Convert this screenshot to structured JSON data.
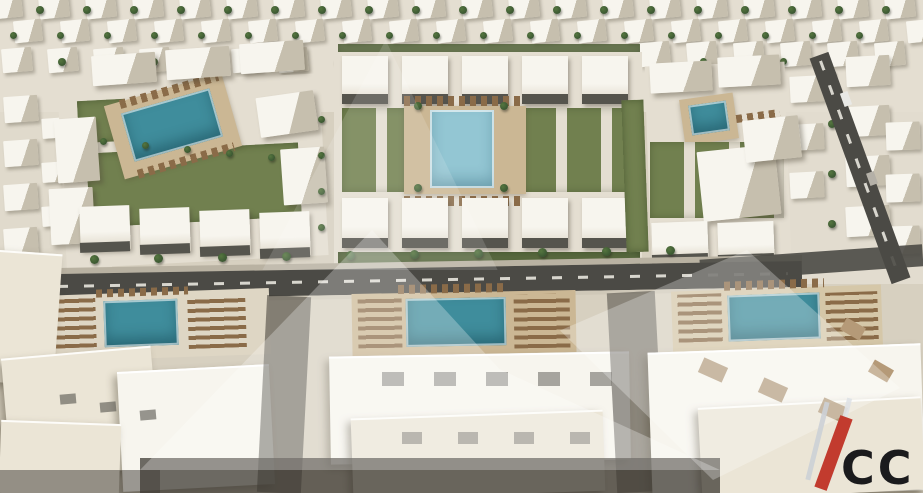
{
  "meta": {
    "image_type": "3d-aerial-architectural-render",
    "description": "Bird's-eye render of a white low-rise residential compound: rows of villas at the horizon, three landscaped courtyard blocks with swimming pools and green garden strips, a main road with street trees, and large foreground apartment rooftops with three pool terraces lined with sun loungers."
  },
  "watermark": {
    "logo_text": "CC"
  },
  "scene": {
    "palette": {
      "sand": "#d7d0c0",
      "sand_light": "#e4ded1",
      "roof_white": "#f7f5ee",
      "roof_shade": "#c6bfae",
      "cream": "#ebe5d6",
      "pool": "#3f8d9c",
      "pool_light": "#93c6d3",
      "grass": "#71804f",
      "grass_dark": "#5a6b40",
      "tree": "#3b5732",
      "road": "#4b4a45",
      "deck": "#cbb794",
      "lounger": "#8a6b48",
      "shade": "#3e3a33",
      "accent_red": "#c23b2e",
      "logo_gray": "#ccd0d6",
      "logo_dark": "#1b1b1d"
    },
    "elements": [
      {
        "n": "ground",
        "x": 0,
        "y": 0,
        "w": 923,
        "h": 493,
        "c": "sand"
      },
      {
        "n": "ground-top",
        "x": 0,
        "y": 0,
        "w": 923,
        "h": 112,
        "c": "sand_light"
      },
      {
        "n": "ground-right",
        "x": 736,
        "y": 36,
        "w": 187,
        "h": 248,
        "c": "sand_light",
        "o": 0.85
      },
      {
        "n": "ground-left",
        "x": 0,
        "y": 96,
        "w": 112,
        "h": 210,
        "c": "sand_light",
        "o": 0.7
      },
      {
        "cls": "villa",
        "n": "villa",
        "x": -8,
        "y": -6,
        "w": 30,
        "h": 24,
        "r": -6,
        "repeat": 20,
        "dx": 47
      },
      {
        "cls": "villa",
        "n": "villa",
        "x": 14,
        "y": 20,
        "w": 28,
        "h": 22,
        "r": -6,
        "repeat": 20,
        "dx": 47
      },
      {
        "cls": "villa",
        "n": "villa",
        "x": 2,
        "y": 48,
        "w": 30,
        "h": 24,
        "r": -5,
        "repeat": 7,
        "dx": 46
      },
      {
        "cls": "villa",
        "n": "villa",
        "x": 640,
        "y": 42,
        "w": 30,
        "h": 24,
        "r": -5,
        "repeat": 6,
        "dx": 47
      },
      {
        "cls": "villa",
        "n": "villa",
        "x": 4,
        "y": 96,
        "w": 34,
        "h": 26,
        "r": -4,
        "repeat": 4,
        "dy": 44
      },
      {
        "cls": "villa",
        "n": "villa",
        "x": 42,
        "y": 118,
        "w": 26,
        "h": 20,
        "r": -4,
        "repeat": 3,
        "dy": 44
      },
      {
        "cls": "villa",
        "n": "villa",
        "x": 846,
        "y": 56,
        "w": 44,
        "h": 30,
        "r": -3,
        "repeat": 4,
        "dy": 50
      },
      {
        "cls": "villa",
        "n": "villa",
        "x": 790,
        "y": 76,
        "w": 34,
        "h": 26,
        "r": -3,
        "repeat": 3,
        "dy": 48
      },
      {
        "cls": "villa",
        "n": "villa",
        "x": 886,
        "y": 122,
        "w": 34,
        "h": 28,
        "r": -2,
        "repeat": 3,
        "dy": 52
      },
      {
        "cls": "tree",
        "n": "tree",
        "x": 36,
        "y": 6,
        "w": 8,
        "h": 8,
        "repeat": 19,
        "dx": 47
      },
      {
        "cls": "tree",
        "n": "tree",
        "x": 10,
        "y": 32,
        "w": 7,
        "h": 7,
        "repeat": 19,
        "dx": 47
      },
      {
        "cls": "tree",
        "n": "tree",
        "x": 58,
        "y": 58,
        "w": 8,
        "h": 8,
        "repeat": 7,
        "dx": 46
      },
      {
        "cls": "tree",
        "n": "palm-tree",
        "x": 828,
        "y": 70,
        "w": 8,
        "h": 8,
        "repeat": 4,
        "dy": 50
      },
      {
        "cls": "tree",
        "n": "palm-tree",
        "x": 700,
        "y": 58,
        "w": 7,
        "h": 7,
        "repeat": 4,
        "dx": 40
      },
      {
        "cls": "road",
        "n": "right-road",
        "x": 850,
        "y": 48,
        "w": 20,
        "h": 240,
        "r": -20
      },
      {
        "cls": "dashv",
        "n": "right-road-line",
        "x": 858,
        "y": 54,
        "w": 3,
        "h": 228,
        "r": -20
      },
      {
        "n": "car",
        "x": 842,
        "y": 92,
        "w": 8,
        "h": 14,
        "c": "#e9e9e6",
        "r": -20
      },
      {
        "n": "car",
        "x": 868,
        "y": 172,
        "w": 8,
        "h": 13,
        "c": "#b4b0a7",
        "r": -20
      },
      {
        "n": "block-left-base",
        "x": 62,
        "y": 80,
        "w": 262,
        "h": 182,
        "c": "sand_light",
        "r": -3
      },
      {
        "cls": "grass",
        "n": "lawn",
        "x": 88,
        "y": 148,
        "w": 212,
        "h": 74,
        "r": -3
      },
      {
        "cls": "grass",
        "n": "lawn",
        "x": 78,
        "y": 100,
        "w": 48,
        "h": 42,
        "r": -3
      },
      {
        "cls": "deck",
        "n": "pool-deck",
        "x": 112,
        "y": 88,
        "w": 122,
        "h": 76,
        "r": -16
      },
      {
        "cls": "loungers",
        "n": "sun-loungers",
        "x": 118,
        "y": 86,
        "w": 102,
        "h": 9,
        "r": -16
      },
      {
        "cls": "pool",
        "n": "swimming-pool",
        "x": 126,
        "y": 100,
        "w": 92,
        "h": 50,
        "r": -16
      },
      {
        "cls": "loungers",
        "n": "sun-loungers",
        "x": 136,
        "y": 156,
        "w": 100,
        "h": 9,
        "r": -16
      },
      {
        "cls": "bldg",
        "n": "apartment-building",
        "x": 92,
        "y": 54,
        "w": 64,
        "h": 30,
        "r": -4,
        "repeat": 3,
        "dx": 74,
        "dy": -6
      },
      {
        "cls": "bldg",
        "n": "apartment-building",
        "x": 56,
        "y": 118,
        "w": 42,
        "h": 64,
        "r": -4
      },
      {
        "cls": "bldg",
        "n": "apartment-building",
        "x": 50,
        "y": 188,
        "w": 44,
        "h": 56,
        "r": -3
      },
      {
        "cls": "bldg",
        "n": "apartment-building",
        "x": 258,
        "y": 94,
        "w": 58,
        "h": 40,
        "r": -8
      },
      {
        "cls": "bldg",
        "n": "apartment-building",
        "x": 282,
        "y": 148,
        "w": 44,
        "h": 56,
        "r": -4
      },
      {
        "cls": "town",
        "n": "townhouse",
        "x": 80,
        "y": 206,
        "w": 50,
        "h": 44,
        "r": -2,
        "repeat": 4,
        "dx": 60,
        "dy": 2
      },
      {
        "cls": "winstrip",
        "n": "facade-windows",
        "x": 80,
        "y": 242,
        "w": 50,
        "h": 10,
        "r": -2,
        "repeat": 4,
        "dx": 60,
        "dy": 2
      },
      {
        "cls": "tree",
        "n": "tree",
        "x": 100,
        "y": 138,
        "w": 7,
        "h": 7,
        "repeat": 5,
        "dx": 42,
        "dy": 4
      },
      {
        "cls": "tree",
        "n": "tree",
        "x": 318,
        "y": 116,
        "w": 7,
        "h": 7,
        "repeat": 4,
        "dy": 36
      },
      {
        "n": "block-center-base",
        "x": 334,
        "y": 52,
        "w": 308,
        "h": 214,
        "c": "sand_light"
      },
      {
        "cls": "grass",
        "n": "hedge",
        "x": 338,
        "y": 44,
        "w": 302,
        "h": 8,
        "c": "grass_dark",
        "o": 0.85
      },
      {
        "cls": "town",
        "n": "townhouse",
        "x": 342,
        "y": 56,
        "w": 46,
        "h": 48,
        "repeat": 5,
        "dx": 60
      },
      {
        "cls": "winstrip",
        "n": "facade-windows",
        "x": 342,
        "y": 94,
        "w": 46,
        "h": 10,
        "repeat": 5,
        "dx": 60
      },
      {
        "cls": "grassrow",
        "n": "garden-strips",
        "x": 342,
        "y": 108,
        "w": 292,
        "h": 84
      },
      {
        "cls": "deck",
        "n": "pool-deck",
        "x": 404,
        "y": 106,
        "w": 122,
        "h": 88
      },
      {
        "cls": "loungers",
        "n": "sun-loungers",
        "x": 404,
        "y": 96,
        "w": 118,
        "h": 10
      },
      {
        "cls": "pool-light",
        "n": "swimming-pool",
        "x": 430,
        "y": 110,
        "w": 64,
        "h": 78
      },
      {
        "cls": "loungers",
        "n": "sun-loungers",
        "x": 404,
        "y": 196,
        "w": 118,
        "h": 10
      },
      {
        "cls": "tree",
        "n": "palm-tree",
        "x": 414,
        "y": 102,
        "w": 8,
        "h": 8
      },
      {
        "cls": "tree",
        "n": "palm-tree",
        "x": 500,
        "y": 102,
        "w": 8,
        "h": 8
      },
      {
        "cls": "tree",
        "n": "palm-tree",
        "x": 414,
        "y": 184,
        "w": 8,
        "h": 8
      },
      {
        "cls": "tree",
        "n": "palm-tree",
        "x": 500,
        "y": 184,
        "w": 8,
        "h": 8
      },
      {
        "cls": "town",
        "n": "townhouse",
        "x": 342,
        "y": 198,
        "w": 46,
        "h": 50,
        "repeat": 5,
        "dx": 60
      },
      {
        "cls": "winstrip",
        "n": "facade-windows",
        "x": 342,
        "y": 238,
        "w": 46,
        "h": 10,
        "repeat": 5,
        "dx": 60
      },
      {
        "cls": "grass",
        "n": "hedge",
        "x": 338,
        "y": 252,
        "w": 302,
        "h": 12,
        "c": "grass_dark"
      },
      {
        "n": "block-right-base",
        "x": 648,
        "y": 64,
        "w": 140,
        "h": 200,
        "c": "sand_light",
        "r": -2
      },
      {
        "cls": "bldg",
        "n": "apartment-building",
        "x": 650,
        "y": 62,
        "w": 62,
        "h": 30,
        "r": -3
      },
      {
        "cls": "bldg",
        "n": "apartment-building",
        "x": 718,
        "y": 56,
        "w": 62,
        "h": 30,
        "r": -3
      },
      {
        "cls": "deck",
        "n": "pool-deck",
        "x": 682,
        "y": 96,
        "w": 54,
        "h": 46,
        "r": -8
      },
      {
        "cls": "pool",
        "n": "swimming-pool",
        "x": 690,
        "y": 103,
        "w": 38,
        "h": 30,
        "r": -8
      },
      {
        "cls": "loungers",
        "n": "sun-loungers",
        "x": 736,
        "y": 112,
        "w": 44,
        "h": 8,
        "r": -8
      },
      {
        "cls": "grassrow",
        "n": "garden-strips",
        "x": 650,
        "y": 142,
        "w": 134,
        "h": 76
      },
      {
        "cls": "bldg",
        "n": "apartment-building",
        "x": 700,
        "y": 148,
        "w": 78,
        "h": 70,
        "r": -6
      },
      {
        "cls": "bldg",
        "n": "apartment-building",
        "x": 744,
        "y": 118,
        "w": 56,
        "h": 42,
        "r": -6
      },
      {
        "cls": "town",
        "n": "townhouse",
        "x": 652,
        "y": 222,
        "w": 56,
        "h": 40,
        "r": -2,
        "repeat": 2,
        "dx": 66
      },
      {
        "cls": "winstrip",
        "n": "facade-windows",
        "x": 652,
        "y": 254,
        "w": 56,
        "h": 9,
        "r": -2,
        "repeat": 2,
        "dx": 66
      },
      {
        "cls": "grass",
        "n": "lawn",
        "x": 624,
        "y": 100,
        "w": 22,
        "h": 152,
        "r": -2
      },
      {
        "n": "sidewalk",
        "x": 0,
        "y": 262,
        "w": 802,
        "h": 6,
        "c": "#b9b2a2",
        "r": -1
      },
      {
        "cls": "road",
        "n": "main-road",
        "x": 0,
        "y": 268,
        "w": 802,
        "h": 26,
        "r": -1
      },
      {
        "cls": "dash",
        "n": "main-road-line",
        "x": 6,
        "y": 279,
        "w": 782,
        "h": 3,
        "r": -1
      },
      {
        "n": "curb",
        "x": 0,
        "y": 294,
        "w": 802,
        "h": 4,
        "c": "#cfc8b8",
        "r": -1
      },
      {
        "cls": "road",
        "n": "road-extension",
        "x": 700,
        "y": 252,
        "w": 223,
        "h": 22,
        "r": -4,
        "o": 0.9
      },
      {
        "cls": "tree",
        "n": "street-tree",
        "x": 26,
        "y": 256,
        "w": 9,
        "h": 9,
        "repeat": 11,
        "dx": 64,
        "dy": -1
      },
      {
        "n": "pool-terrace",
        "x": 40,
        "y": 292,
        "w": 230,
        "h": 66,
        "c": "#ded6c4",
        "r": -2
      },
      {
        "cls": "loungersv",
        "n": "sun-loungers",
        "x": 48,
        "y": 298,
        "w": 48,
        "h": 50,
        "r": -2
      },
      {
        "cls": "pool",
        "n": "swimming-pool",
        "x": 104,
        "y": 300,
        "w": 74,
        "h": 46,
        "r": -2
      },
      {
        "cls": "loungersv",
        "n": "sun-loungers",
        "x": 188,
        "y": 296,
        "w": 58,
        "h": 52,
        "r": -2
      },
      {
        "cls": "loungers",
        "n": "sun-loungers",
        "x": 96,
        "y": 288,
        "w": 92,
        "h": 8,
        "r": -2
      },
      {
        "cls": "roof",
        "n": "rooftop",
        "x": -6,
        "y": 252,
        "w": 64,
        "h": 130,
        "r": 4
      },
      {
        "cls": "roof",
        "n": "rooftop",
        "x": 6,
        "y": 352,
        "w": 150,
        "h": 120,
        "r": -5
      },
      {
        "cls": "roof-white",
        "n": "rooftop",
        "x": 120,
        "y": 368,
        "w": 152,
        "h": 118,
        "r": -3
      },
      {
        "cls": "roof",
        "n": "rooftop",
        "x": 0,
        "y": 422,
        "w": 120,
        "h": 71,
        "r": 2
      },
      {
        "cls": "winstrip",
        "n": "roof-vent",
        "x": 60,
        "y": 394,
        "w": 16,
        "h": 10,
        "r": -5,
        "repeat": 3,
        "dx": 40,
        "dy": 8,
        "o": 0.6
      },
      {
        "cls": "shade",
        "n": "alley-shadow",
        "x": 262,
        "y": 296,
        "w": 44,
        "h": 197,
        "r": 3,
        "o": 0.55
      },
      {
        "n": "pool-terrace",
        "x": 352,
        "y": 292,
        "w": 224,
        "h": 62,
        "c": "deck",
        "r": -1
      },
      {
        "cls": "loungersv",
        "n": "sun-loungers",
        "x": 358,
        "y": 296,
        "w": 44,
        "h": 52,
        "r": -1
      },
      {
        "cls": "pool",
        "n": "swimming-pool",
        "x": 406,
        "y": 298,
        "w": 100,
        "h": 48,
        "r": -1
      },
      {
        "cls": "loungersv",
        "n": "sun-loungers",
        "x": 514,
        "y": 294,
        "w": 56,
        "h": 54,
        "r": -1
      },
      {
        "cls": "loungers",
        "n": "sun-loungers",
        "x": 398,
        "y": 284,
        "w": 110,
        "h": 9,
        "r": -1
      },
      {
        "cls": "roof-white",
        "n": "rooftop",
        "x": 330,
        "y": 354,
        "w": 300,
        "h": 106,
        "r": -1
      },
      {
        "cls": "roof",
        "n": "rooftop",
        "x": 352,
        "y": 414,
        "w": 252,
        "h": 79,
        "r": -2
      },
      {
        "cls": "winstrip",
        "n": "roof-vent",
        "x": 382,
        "y": 372,
        "w": 22,
        "h": 14,
        "repeat": 5,
        "dx": 52,
        "o": 0.5
      },
      {
        "cls": "winstrip",
        "n": "roof-vent",
        "x": 402,
        "y": 432,
        "w": 20,
        "h": 12,
        "repeat": 4,
        "dx": 56,
        "o": 0.5
      },
      {
        "cls": "shade",
        "n": "alley-shadow",
        "x": 612,
        "y": 292,
        "w": 48,
        "h": 200,
        "r": -3,
        "o": 0.5
      },
      {
        "n": "pool-terrace",
        "x": 672,
        "y": 288,
        "w": 210,
        "h": 62,
        "c": "#d5c7a8",
        "r": -2
      },
      {
        "cls": "loungersv",
        "n": "sun-loungers",
        "x": 678,
        "y": 294,
        "w": 44,
        "h": 48,
        "r": -2
      },
      {
        "cls": "pool",
        "n": "swimming-pool",
        "x": 728,
        "y": 294,
        "w": 92,
        "h": 46,
        "r": -2
      },
      {
        "cls": "loungersv",
        "n": "sun-loungers",
        "x": 826,
        "y": 292,
        "w": 52,
        "h": 48,
        "r": -2
      },
      {
        "cls": "loungers",
        "n": "sun-loungers",
        "x": 724,
        "y": 280,
        "w": 100,
        "h": 9,
        "r": -2
      },
      {
        "cls": "roof-white",
        "n": "rooftop",
        "x": 650,
        "y": 348,
        "w": 273,
        "h": 145,
        "r": -2
      },
      {
        "cls": "roof",
        "n": "rooftop",
        "x": 700,
        "y": 402,
        "w": 223,
        "h": 91,
        "r": -3
      },
      {
        "n": "roof-patch",
        "x": 700,
        "y": 362,
        "w": 26,
        "h": 16,
        "c": "#a98f6d",
        "r": 24,
        "repeat": 3,
        "dx": 60,
        "dy": 20,
        "o": 0.85
      },
      {
        "n": "roof-patch",
        "x": 842,
        "y": 322,
        "w": 22,
        "h": 14,
        "c": "#b59a78",
        "r": 30,
        "repeat": 2,
        "dx": 28,
        "dy": 42
      },
      {
        "cls": "shade",
        "n": "bottom-street",
        "x": 140,
        "y": 458,
        "w": 580,
        "h": 35,
        "o": 0.75
      },
      {
        "cls": "shade",
        "n": "street-shadow",
        "x": 0,
        "y": 470,
        "w": 160,
        "h": 23,
        "o": 0.5
      },
      {
        "cls": "wm wm1",
        "n": "watermark-shape",
        "x": 140,
        "y": 230,
        "w": 580,
        "h": 240
      },
      {
        "cls": "wm wm2",
        "n": "watermark-shape",
        "x": 560,
        "y": 250,
        "w": 340,
        "h": 230
      },
      {
        "cls": "wm wm3",
        "n": "watermark-shape",
        "x": 240,
        "y": 40,
        "w": 280,
        "h": 230,
        "o": 0.5
      }
    ]
  }
}
